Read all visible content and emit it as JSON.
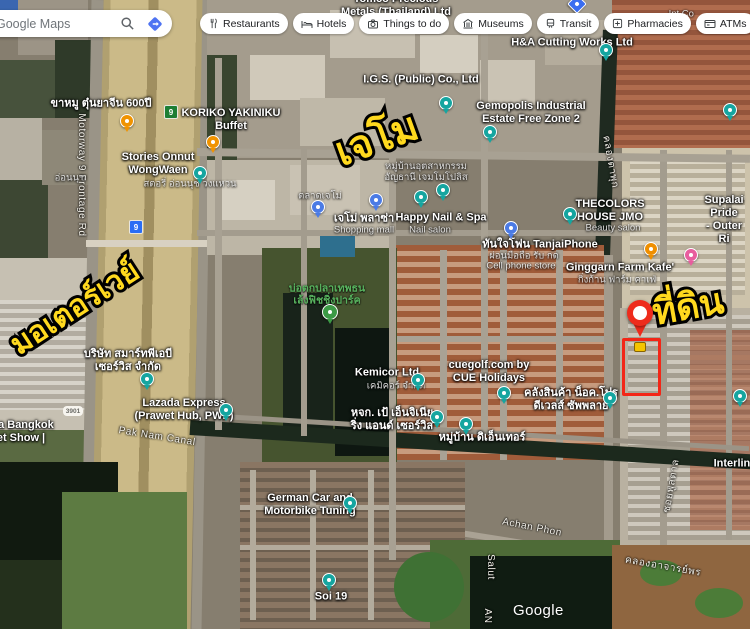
{
  "topbar": {
    "search": {
      "value": "Google Maps",
      "search_icon": "magnifier",
      "directions_icon": "blue-diamond-arrow"
    },
    "chips": [
      {
        "id": "restaurants",
        "label": "Restaurants",
        "icon": "restaurants"
      },
      {
        "id": "hotels",
        "label": "Hotels",
        "icon": "hotels"
      },
      {
        "id": "things-to-do",
        "label": "Things to do",
        "icon": "things"
      },
      {
        "id": "museums",
        "label": "Museums",
        "icon": "museums"
      },
      {
        "id": "transit",
        "label": "Transit",
        "icon": "transit"
      },
      {
        "id": "pharmacies",
        "label": "Pharmacies",
        "icon": "pharmacies"
      },
      {
        "id": "atms",
        "label": "ATMs",
        "icon": "atms"
      }
    ]
  },
  "annotations": {
    "motorway_text": "มอเตอร์เวย์",
    "jemo_text": "เจโม",
    "land_text": "ที่ดิน",
    "annotation_yellow": "#ffd91e",
    "annotation_red": "#f32617"
  },
  "map": {
    "watermark": "Google",
    "labels": [
      {
        "id": "tomco",
        "type": "place",
        "x": 396,
        "y": 6,
        "rot": 0,
        "lines": [
          "Tomco Precious",
          "Metals (Thailand) Ltd"
        ]
      },
      {
        "id": "intl-co",
        "type": "faint",
        "x": 676,
        "y": 14,
        "rot": 0,
        "lines": [
          "... Int Co"
        ]
      },
      {
        "id": "ha-cutting",
        "type": "place",
        "x": 572,
        "y": 43,
        "rot": 0,
        "lines": [
          "H&A Cutting Works Ltd"
        ]
      },
      {
        "id": "igs",
        "type": "place",
        "x": 421,
        "y": 80,
        "rot": 0,
        "lines": [
          "I.G.S. (Public) Co., Ltd"
        ]
      },
      {
        "id": "gemopolis",
        "type": "place",
        "x": 531,
        "y": 113,
        "rot": 0,
        "lines": [
          "Gemopolis Industrial",
          "Estate Free Zone 2"
        ]
      },
      {
        "id": "khamu",
        "type": "place",
        "x": 101,
        "y": 104,
        "rot": 0,
        "lines": [
          "ขาหมู ตุ๋นยาจีน 600ปี"
        ]
      },
      {
        "id": "koriko",
        "type": "place",
        "x": 231,
        "y": 120,
        "rot": 0,
        "lines": [
          "KORIKO YAKINIKU",
          "Buffet"
        ]
      },
      {
        "id": "stories",
        "type": "place",
        "x": 158,
        "y": 164,
        "rot": 0,
        "lines": [
          "Stories Onnut",
          "WongWaen"
        ]
      },
      {
        "id": "stories-sub",
        "type": "faint",
        "x": 190,
        "y": 184,
        "rot": 0,
        "lines": [
          "สตอรี่ อ่อนนุช วงแหวน"
        ]
      },
      {
        "id": "onnut-road",
        "type": "faint",
        "x": 70,
        "y": 178,
        "rot": 0,
        "lines": [
          "อ่อนนุช"
        ]
      },
      {
        "id": "anchani",
        "type": "faint",
        "x": 426,
        "y": 172,
        "rot": 0,
        "lines": [
          "หมู่บ้านอุตสาหกรรม",
          "อัญธานี เจมโมโปลิส"
        ]
      },
      {
        "id": "talad-jemo",
        "type": "faint",
        "x": 320,
        "y": 196,
        "rot": 0,
        "lines": [
          "ตลาดเจโม่"
        ]
      },
      {
        "id": "jemo-plaza",
        "type": "place",
        "x": 364,
        "y": 219,
        "rot": 0,
        "lines": [
          "เจโม่ พลาซ่า"
        ]
      },
      {
        "id": "jemo-plaza-sub",
        "type": "faint",
        "x": 364,
        "y": 230,
        "rot": 0,
        "lines": [
          "Shopping mall"
        ]
      },
      {
        "id": "happy-nail",
        "type": "place",
        "x": 441,
        "y": 218,
        "rot": 0,
        "lines": [
          "Happy Nail & Spa"
        ]
      },
      {
        "id": "happy-nail-sub",
        "type": "faint",
        "x": 430,
        "y": 230,
        "rot": 0,
        "lines": [
          "Nail salon"
        ]
      },
      {
        "id": "thecolors",
        "type": "place",
        "x": 610,
        "y": 211,
        "rot": 0,
        "lines": [
          "THECOLORS",
          "HOUSE JMO"
        ]
      },
      {
        "id": "thecolors-sub",
        "type": "faint",
        "x": 613,
        "y": 228,
        "rot": 0,
        "lines": [
          "Beauty salon"
        ]
      },
      {
        "id": "supalai",
        "type": "place",
        "x": 724,
        "y": 220,
        "rot": 0,
        "lines": [
          "Supalai Pride",
          "- Outer Ri"
        ]
      },
      {
        "id": "tanjai",
        "type": "place",
        "x": 540,
        "y": 245,
        "rot": 0,
        "lines": [
          "ทันใจโฟน TanjaiPhone"
        ]
      },
      {
        "id": "tanjai-sub1",
        "type": "faint",
        "x": 524,
        "y": 256,
        "rot": 0,
        "lines": [
          "ผ่อนมือถือ รับ กด"
        ]
      },
      {
        "id": "tanjai-sub2",
        "type": "faint",
        "x": 521,
        "y": 266,
        "rot": 0,
        "lines": [
          "Cell phone store"
        ]
      },
      {
        "id": "ginggarn",
        "type": "place",
        "x": 620,
        "y": 268,
        "rot": 0,
        "lines": [
          "Ginggarn Farm Kafe'"
        ]
      },
      {
        "id": "ginggarn-sub",
        "type": "faint",
        "x": 617,
        "y": 280,
        "rot": 0,
        "lines": [
          "กิ่งก้าน ฟาร์ม คาเฟ่"
        ]
      },
      {
        "id": "fishing-park",
        "type": "green",
        "x": 327,
        "y": 295,
        "rot": 0,
        "lines": [
          "บ่อตกปลาเทพธน",
          "เล้งฟิชชิ่งปาร์ค"
        ]
      },
      {
        "id": "kemicor",
        "type": "place",
        "x": 387,
        "y": 373,
        "rot": 0,
        "lines": [
          "Kemicor Ltd"
        ]
      },
      {
        "id": "kemicor-sub",
        "type": "faint",
        "x": 396,
        "y": 386,
        "rot": 0,
        "lines": [
          "เคมิคอร์ จำกัด"
        ]
      },
      {
        "id": "cuegolf",
        "type": "place",
        "x": 489,
        "y": 372,
        "rot": 0,
        "lines": [
          "cuegolf.com by",
          "CUE Holidays"
        ]
      },
      {
        "id": "pao-eng",
        "type": "place",
        "x": 392,
        "y": 420,
        "rot": 0,
        "lines": [
          "หจก. เป้ เอ็นจิเนีย",
          "ริ่ง แอนด์ เซอร์วิส"
        ]
      },
      {
        "id": "the-enter",
        "type": "place",
        "x": 482,
        "y": 438,
        "rot": 0,
        "lines": [
          "หมู่บ้าน ดิเอ็นเทอร์"
        ]
      },
      {
        "id": "warehouse-nok",
        "type": "place",
        "x": 571,
        "y": 400,
        "rot": 0,
        "lines": [
          "คลังสินค้า น็อค.โปร",
          "ดีเวลส์ ซัพพลาย"
        ]
      },
      {
        "id": "smart-pab",
        "type": "place",
        "x": 128,
        "y": 361,
        "rot": 0,
        "lines": [
          "บริษัท สมาร์ทพีเอบี",
          "เซอร์วิส จำกัด"
        ]
      },
      {
        "id": "lazada",
        "type": "place",
        "x": 184,
        "y": 410,
        "rot": 0,
        "lines": [
          "Lazada Express",
          "(Prawet Hub, PWP)"
        ]
      },
      {
        "id": "bangkok-show",
        "type": "place",
        "x": 21,
        "y": 432,
        "rot": 0,
        "lines": [
          "ma Bangkok",
          "et Show |"
        ]
      },
      {
        "id": "pak-nam-canal",
        "type": "road",
        "x": 157,
        "y": 437,
        "rot": 9,
        "lines": [
          "Pak Nam Canal"
        ]
      },
      {
        "id": "german-car",
        "type": "place",
        "x": 310,
        "y": 505,
        "rot": 0,
        "lines": [
          "German Car and",
          "Motorbike Tuning"
        ]
      },
      {
        "id": "soi-19",
        "type": "place",
        "x": 331,
        "y": 597,
        "rot": 0,
        "lines": [
          "Soi 19"
        ]
      },
      {
        "id": "achan-phon",
        "type": "road",
        "x": 532,
        "y": 528,
        "rot": 11,
        "lines": [
          "Achan Phon"
        ]
      },
      {
        "id": "khlong-achan-phon",
        "type": "road",
        "x": 663,
        "y": 567,
        "rot": 10,
        "lines": [
          "คลองอาจารย์พร"
        ]
      },
      {
        "id": "motorway-frontage",
        "type": "road",
        "x": 81,
        "y": 175,
        "rot": 90,
        "lines": [
          "Motorway 9 Frontage Rd"
        ]
      },
      {
        "id": "khlong-ta-phuk",
        "type": "road",
        "x": 610,
        "y": 162,
        "rot": 80,
        "lines": [
          "คลองตาพุก"
        ]
      },
      {
        "id": "salut",
        "type": "road",
        "x": 490,
        "y": 567,
        "rot": 90,
        "lines": [
          "Salut"
        ]
      },
      {
        "id": "an",
        "type": "road",
        "x": 487,
        "y": 616,
        "rot": 90,
        "lines": [
          "AN"
        ]
      },
      {
        "id": "soi-phun",
        "type": "road",
        "x": 672,
        "y": 486,
        "rot": -80,
        "lines": [
          "ซอยพูลตาล"
        ]
      },
      {
        "id": "interline",
        "type": "place",
        "x": 735,
        "y": 464,
        "rot": 0,
        "lines": [
          "Interline"
        ]
      },
      {
        "id": "annot-motorway",
        "type": "yellow",
        "x": 75,
        "y": 308,
        "rot": -33,
        "size": 30,
        "lines": [
          "มอเตอร์เวย์"
        ]
      },
      {
        "id": "annot-jemo",
        "type": "yellow",
        "x": 377,
        "y": 140,
        "rot": -20,
        "size": 40,
        "lines": [
          "เจโม"
        ]
      },
      {
        "id": "annot-tidin",
        "type": "yellow",
        "x": 688,
        "y": 307,
        "rot": -10,
        "size": 36,
        "lines": [
          "ที่ดิน"
        ]
      }
    ],
    "pins": [
      {
        "type": "restaurant",
        "x": 127,
        "y": 121
      },
      {
        "type": "restaurant",
        "x": 213,
        "y": 142
      },
      {
        "type": "default",
        "x": 200,
        "y": 173
      },
      {
        "type": "default",
        "x": 446,
        "y": 103
      },
      {
        "type": "default",
        "x": 490,
        "y": 132
      },
      {
        "type": "default",
        "x": 606,
        "y": 50
      },
      {
        "type": "default",
        "x": 730,
        "y": 110
      },
      {
        "type": "default",
        "x": 421,
        "y": 197
      },
      {
        "type": "default",
        "x": 443,
        "y": 190
      },
      {
        "type": "default",
        "x": 570,
        "y": 214
      },
      {
        "type": "shopping",
        "x": 318,
        "y": 207
      },
      {
        "type": "shopping",
        "x": 376,
        "y": 200
      },
      {
        "type": "shopping",
        "x": 511,
        "y": 228
      },
      {
        "type": "cafe",
        "x": 651,
        "y": 249
      },
      {
        "type": "pink",
        "x": 691,
        "y": 255
      },
      {
        "type": "park",
        "x": 330,
        "y": 312
      },
      {
        "type": "default",
        "x": 418,
        "y": 380
      },
      {
        "type": "default",
        "x": 504,
        "y": 393
      },
      {
        "type": "default",
        "x": 437,
        "y": 417
      },
      {
        "type": "default",
        "x": 466,
        "y": 424
      },
      {
        "type": "default",
        "x": 610,
        "y": 398
      },
      {
        "type": "default",
        "x": 147,
        "y": 379
      },
      {
        "type": "default",
        "x": 226,
        "y": 410
      },
      {
        "type": "default",
        "x": 350,
        "y": 503
      },
      {
        "type": "default",
        "x": 329,
        "y": 580
      },
      {
        "type": "default",
        "x": 740,
        "y": 396
      },
      {
        "type": "diamond",
        "x": 577,
        "y": 4
      }
    ],
    "shields": [
      {
        "text": "9",
        "style": "green",
        "x": 171,
        "y": 112
      },
      {
        "text": "9",
        "style": "blue",
        "x": 136,
        "y": 227
      },
      {
        "text": "3901",
        "style": "white",
        "x": 73,
        "y": 411
      }
    ]
  }
}
